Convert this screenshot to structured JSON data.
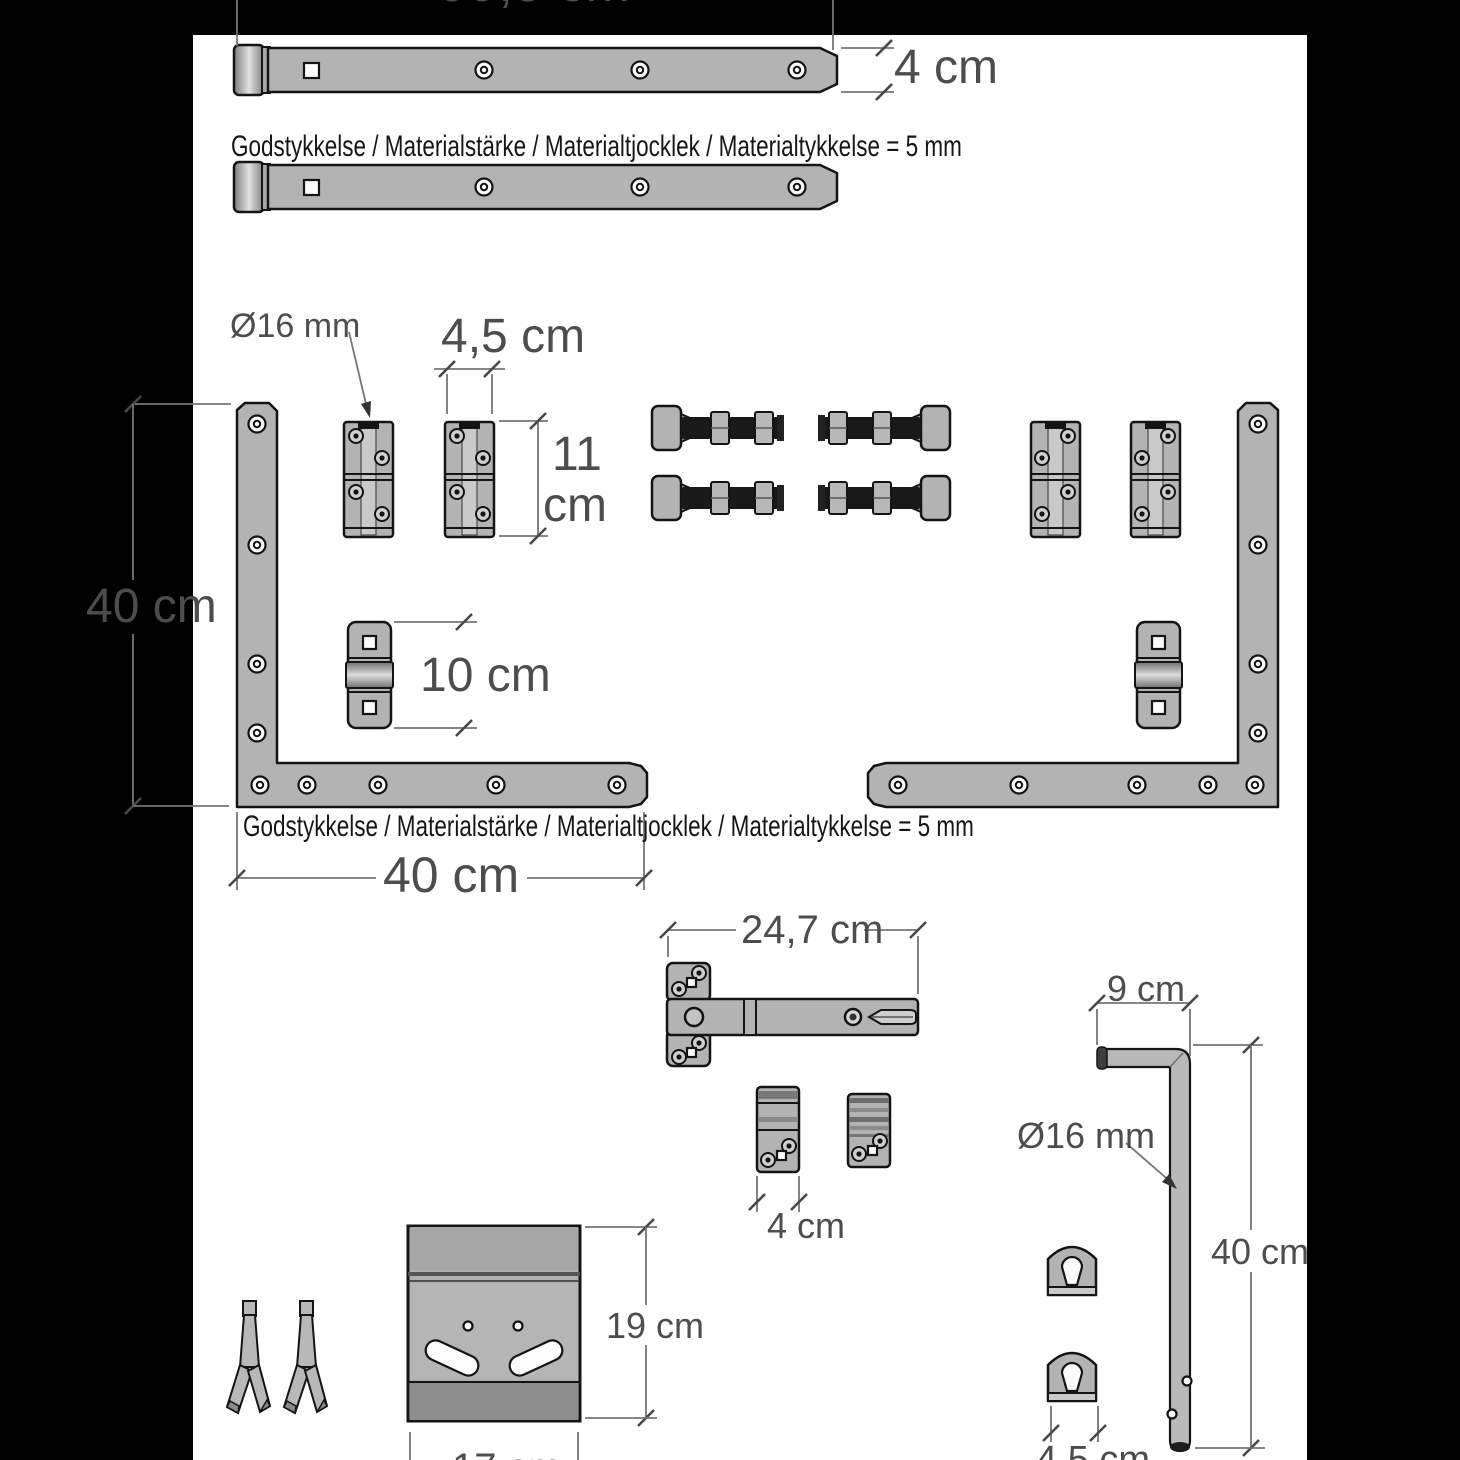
{
  "colors": {
    "background": "#000000",
    "paper": "#ffffff",
    "part_fill": "#b3b3b3",
    "outline": "#141414",
    "dim_line": "#757575",
    "dim_text": "#4d4d4d",
    "note_text": "#161616"
  },
  "labels": {
    "top_length": "99,5 cm",
    "strap_width": "4 cm",
    "thickness_note": "Godstykkelse / Materialstärke / Materialtjocklek / Materialtykkelse = 5 mm",
    "pin_diameter": "Ø16 mm",
    "hinge_width": "4,5 cm",
    "hinge_height_value": "11",
    "hinge_height_unit": "cm",
    "bracket_height": "40 cm",
    "keeper_height": "10 cm",
    "bracket_width": "40 cm",
    "t_hinge_length": "24,7 cm",
    "handle_length": "9 cm",
    "rod_diameter": "Ø16 mm",
    "rod_length": "40 cm",
    "catch_width": "4 cm",
    "plate_height": "19 cm",
    "eyelet_width": "4,5 cm",
    "plate_width": "17 cm"
  }
}
